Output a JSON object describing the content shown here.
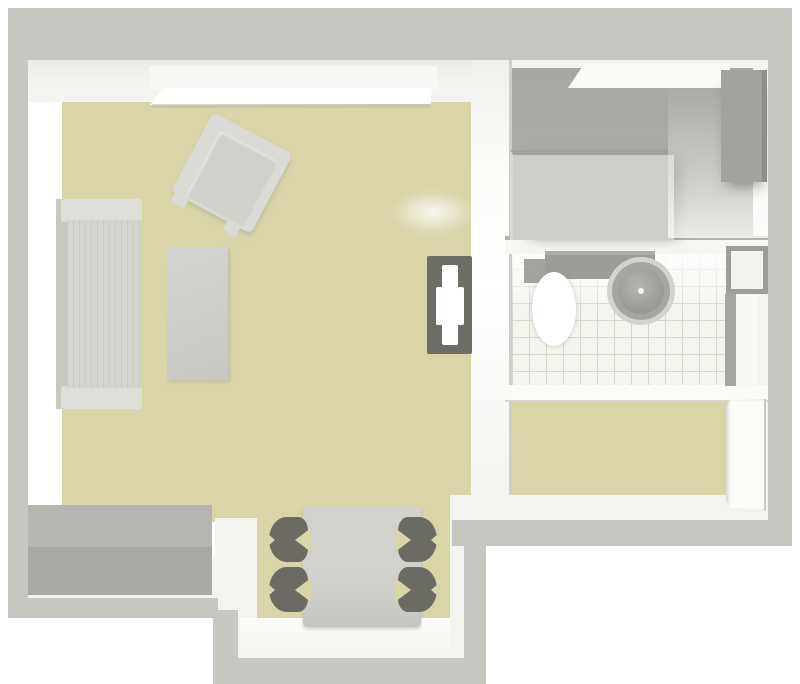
{
  "scene": {
    "type": "3d-floorplan-top-down-render",
    "rooms": [
      {
        "name": "living-room",
        "floor": "beige",
        "furniture": [
          "window-light-strip",
          "sofa",
          "armchair",
          "coffee-table",
          "tv",
          "sideboard"
        ]
      },
      {
        "name": "dining-nook",
        "floor": "beige",
        "furniture": [
          "dining-table",
          "chair-pair-left",
          "chair-pair-right"
        ]
      },
      {
        "name": "kitchen-room",
        "floor": "gray",
        "furniture": [
          "white-counter",
          "tall-cabinet",
          "worktop-block"
        ]
      },
      {
        "name": "bathroom",
        "floor": "white-tile",
        "furniture": [
          "toilet",
          "cistern",
          "round-washbasin",
          "wall-cabinet",
          "bathtub"
        ]
      },
      {
        "name": "hallway-room",
        "floor": "beige",
        "furniture": [
          "open-door-leaf"
        ]
      }
    ]
  },
  "palette": {
    "outside": "#ffffff",
    "wall-top": "#c7c7c2",
    "wall-face": "#f3f3ef",
    "wall-face-bright": "#ffffff",
    "floor-living": "#d9d5a9",
    "floor-room-dark": "#a7a7a2",
    "floor-room-mid": "#b4b4af",
    "bath-tile": "#f4f4ee",
    "tile-grout": "#d7d7d0",
    "divider-shadow": "#b4b4af",
    "sofa-arm": "#dfdfda",
    "sofa-seat": "#d6d6d1",
    "sofa-back": "#c8c8c3",
    "coffee-table-a": "#d4d4cf",
    "coffee-table-b": "#c8c8c3",
    "armchair-frame": "#dbdbd6",
    "armchair-seat": "#d1d1cc",
    "tv-panel": "#6d6d66",
    "tv-mount": "#ffffff",
    "sideboard-top": "#b6b6b1",
    "sideboard-front": "#a9a9a4",
    "dining-table-a": "#d2d2cd",
    "dining-table-b": "#c6c6c1",
    "chair-dark": "#6b6b63",
    "counter-white": "#fafaf7",
    "cabinet": "#a2a29e",
    "cabinet-edge": "#8f8f8b",
    "block-top-seam": "#a2a29d",
    "block-light": "#cdcdc9",
    "toilet-tank": "#9d9d98",
    "toilet-bowl": "#ffffff",
    "sink-halo": "#d3d3cd",
    "sink-ring": "#a6a6a1",
    "sink-bowl-a": "#b6b6b0",
    "sink-bowl-b": "#8d8d87",
    "tub-edge": "#a6a6a1",
    "tub-white": "#f8f8f4",
    "door-white": "#fcfcf9"
  }
}
